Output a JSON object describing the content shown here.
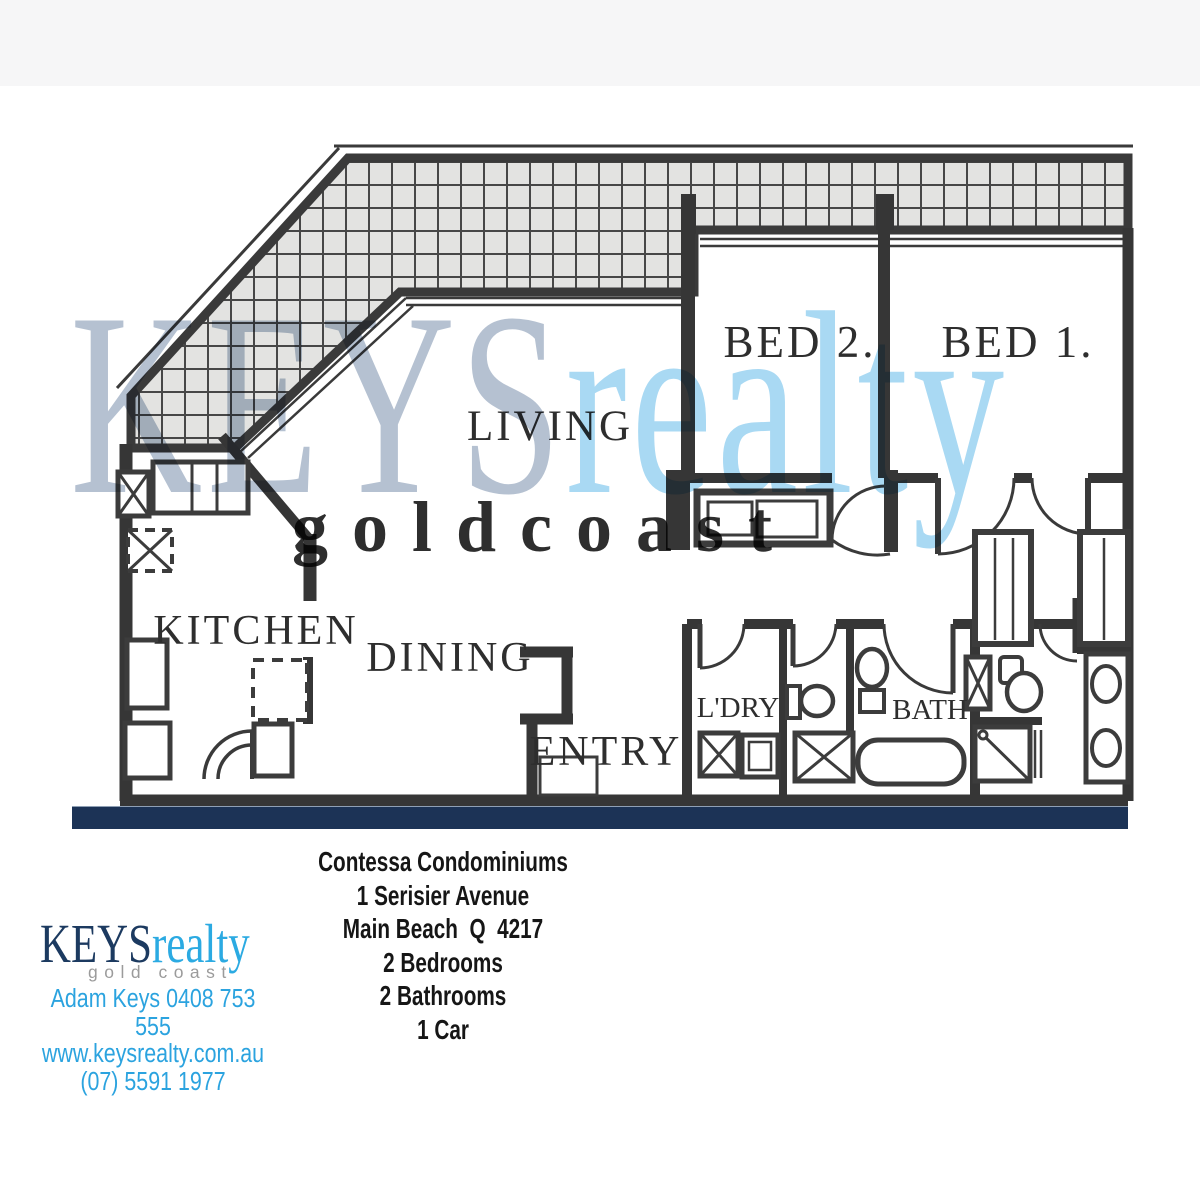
{
  "floorplan": {
    "rooms": {
      "living": "LIVING",
      "kitchen": "KITCHEN",
      "dining": "DINING",
      "entry": "ENTRY",
      "bed2": "BED 2.",
      "bed1": "BED 1.",
      "laundry": "L'DRY",
      "bath": "BATH"
    }
  },
  "watermark": {
    "keys": "KEYS",
    "realty": "realty",
    "tagline": "g o l d   c o a s t"
  },
  "property": {
    "lines": [
      "Contessa Condominiums",
      "1 Serisier Avenue",
      "Main Beach  Q  4217",
      "2 Bedrooms",
      "2 Bathrooms",
      "1 Car"
    ]
  },
  "agency": {
    "name_keys": "KEYS",
    "name_realty": "realty",
    "tagline": "gold coast",
    "agent_line": "Adam Keys 0408 753 555",
    "website": "www.keysrealty.com.au",
    "phone": "(07) 5591 1977"
  },
  "colors": {
    "navy_bar": "#1c3356",
    "logo_navy": "#1c3a60",
    "brand_blue": "#2baae2",
    "contact_blue": "#2ba3df",
    "watermark_keys": "#b5c1d1",
    "watermark_realty": "#a9d9f3",
    "watermark_gray": "#d9d9d9",
    "wall_ink": "#363636",
    "tile_fill": "#e3e3e1"
  }
}
